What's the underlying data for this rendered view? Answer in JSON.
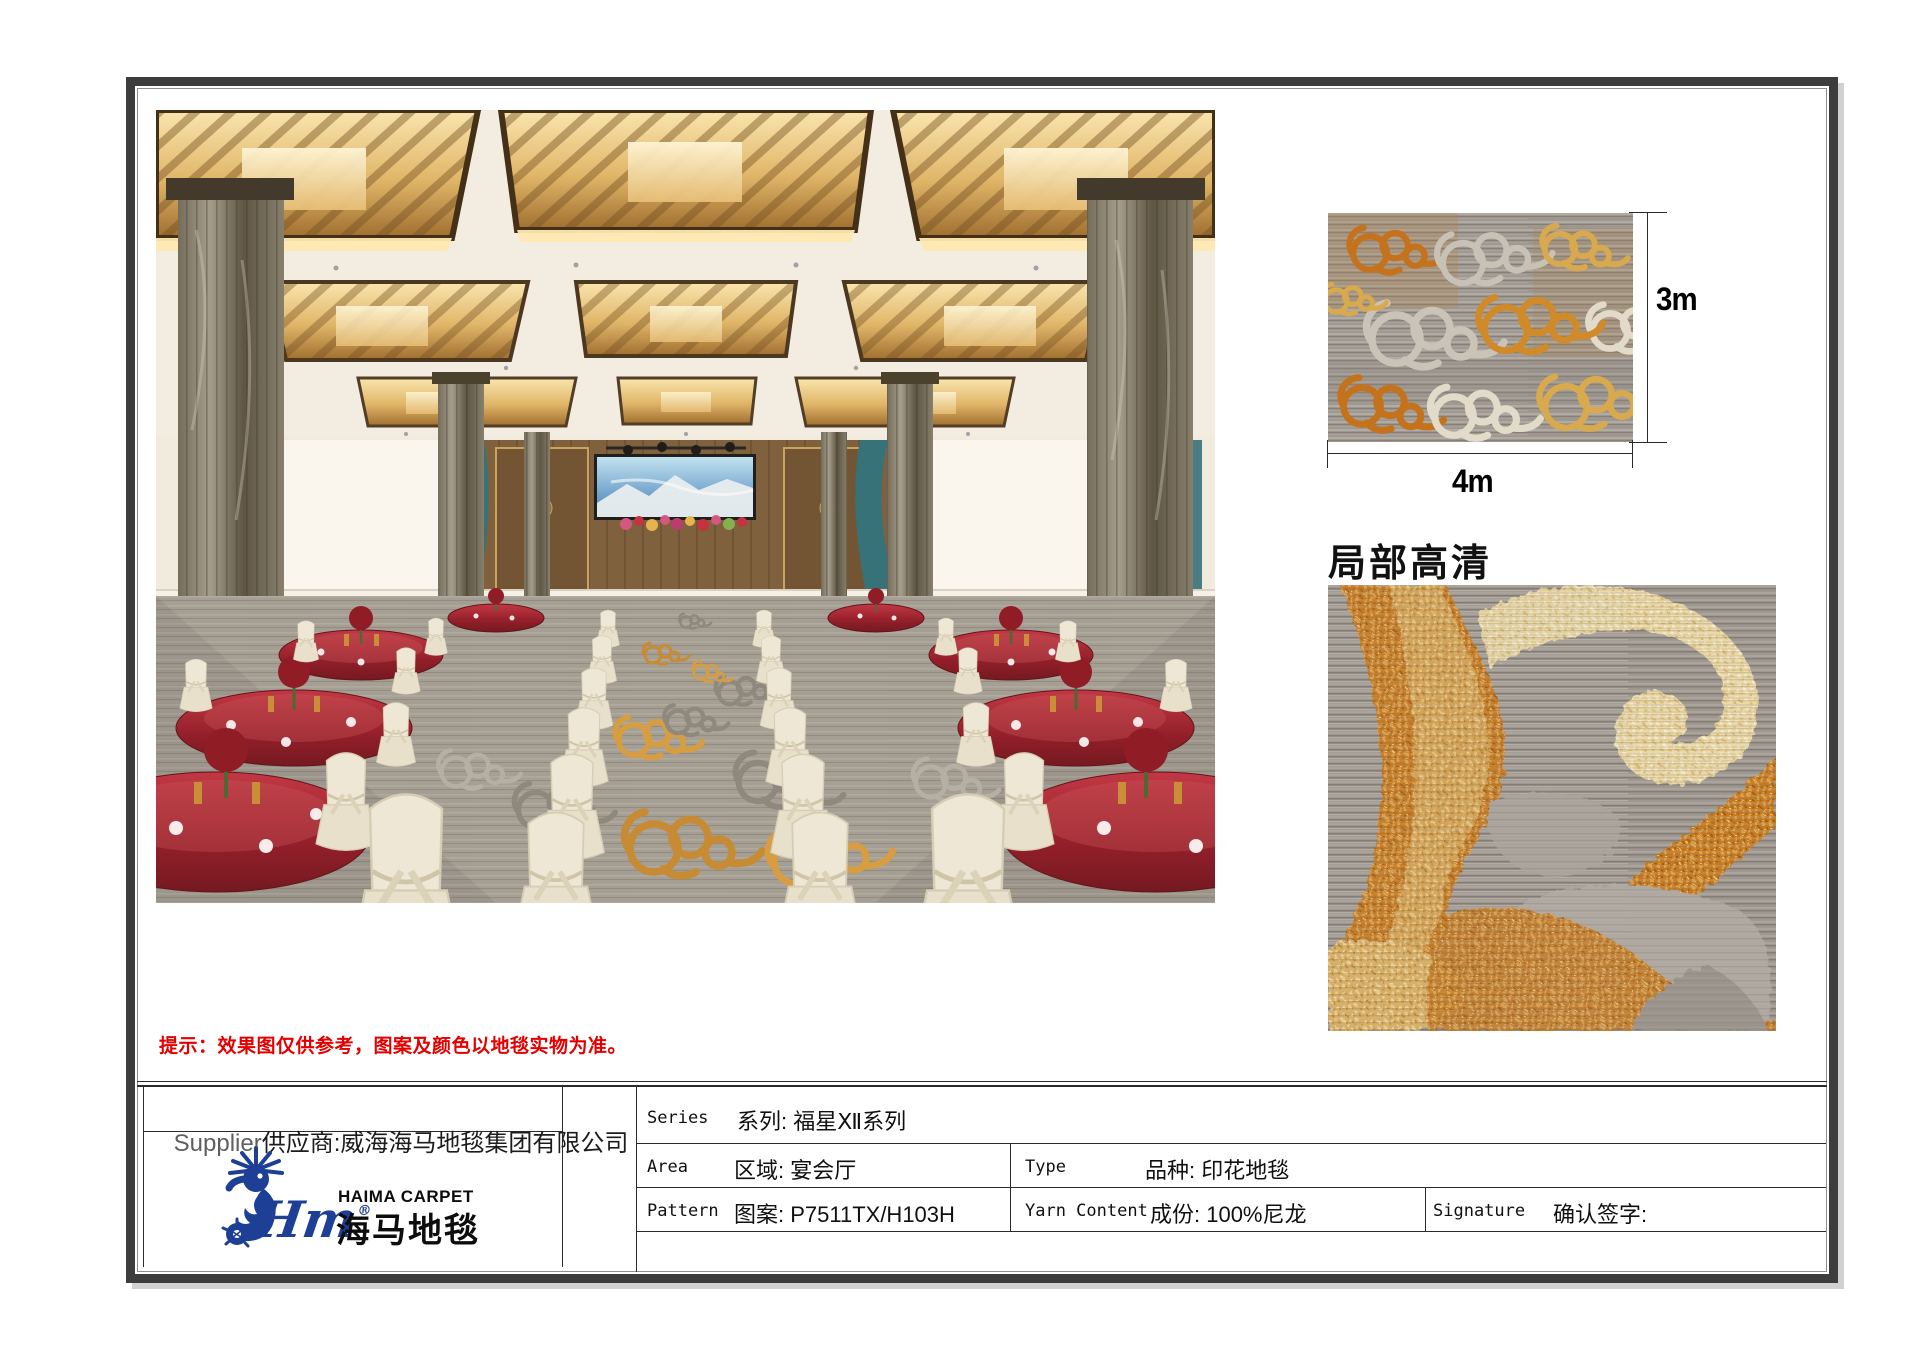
{
  "page": {
    "notice": "提示：效果图仅供参考，图案及颜色以地毯实物为准。",
    "detail_section_title": "局部高清",
    "swatch": {
      "height_label": "3m",
      "width_label": "4m"
    }
  },
  "supplier_block": {
    "supplier_en": "Supplier",
    "supplier_cn": "供应商:威海海马地毯集团有限公司"
  },
  "logo": {
    "script": "Hm",
    "registered": "®",
    "brand_en": "HAIMA CARPET",
    "brand_cn": "海马地毯"
  },
  "spec_table": {
    "series": {
      "en": "Series",
      "cn": "系列: 福星Ⅻ系列"
    },
    "area": {
      "en": "Area",
      "cn": "区域: 宴会厅"
    },
    "pattern": {
      "en": "Pattern",
      "cn": "图案: P7511TX/H103H"
    },
    "type": {
      "en": "Type",
      "cn": "品种: 印花地毯"
    },
    "yarn_content": {
      "en": "Yarn Content",
      "cn": "成份: 100%尼龙"
    },
    "signature": {
      "en": "Signature",
      "cn": "确认签字:"
    }
  },
  "colors": {
    "accent_red": "#e50000",
    "logo_blue": "#1d3f96",
    "carpet_orange": "#c4731c",
    "carpet_gold": "#d9a94e",
    "carpet_gray": "#9d978f",
    "carpet_cream": "#e3dbca"
  }
}
